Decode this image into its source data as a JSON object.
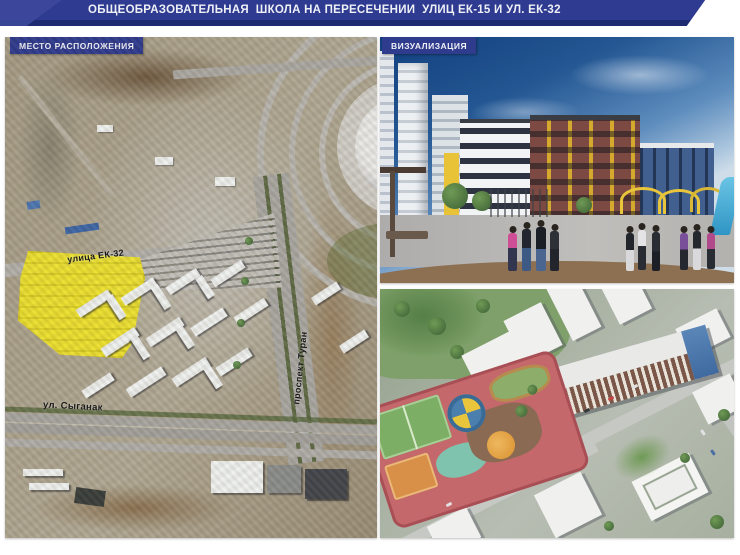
{
  "banner": {
    "title": "ОБЩЕОБРАЗОВАТЕЛЬНАЯ  ШКОЛА НА ПЕРЕСЕЧЕНИИ  УЛИЦ ЕК-15 И УЛ. ЕК-32"
  },
  "location_panel": {
    "badge_label": "МЕСТО РАСПОЛОЖЕНИЯ",
    "street_labels": {
      "ek32": "улица ЕК-32",
      "syganak": "ул. Сыганак",
      "turan": "проспект Туран"
    }
  },
  "visualization_panel": {
    "badge_label": "ВИЗУАЛИЗАЦИЯ"
  },
  "colors": {
    "banner_blue": "#2e3b90",
    "banner_dark_strip": "#1f2b70",
    "badge_blue": "#2f3b8d",
    "site_highlight_yellow": "#efe43c",
    "sky_blue": "#235692",
    "brick_facade": "#7c4a42",
    "accent_yellow": "#e8c337",
    "glass_blue": "#41608f"
  }
}
